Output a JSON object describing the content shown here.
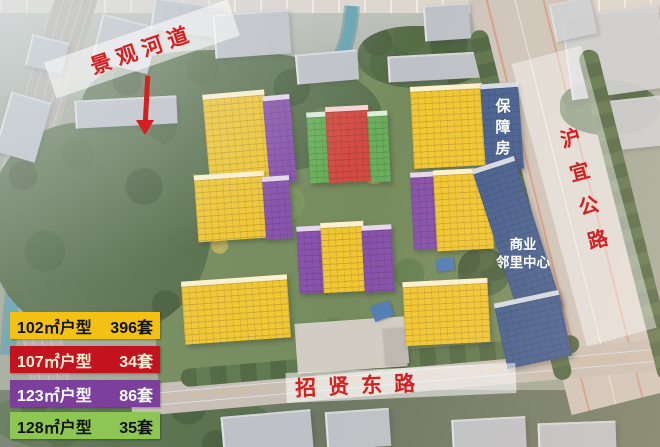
{
  "labels": {
    "river_channel": "景观河道",
    "huyi_highway": "沪宜公路",
    "zhaoxian_east_road": "招贤东路",
    "affordable_housing": "保障房",
    "commercial_center_line1": "商业",
    "commercial_center_line2": "邻里中心"
  },
  "legend": {
    "items": [
      {
        "type": "102㎡户型",
        "count": "396套",
        "bg": "#f2c113",
        "fg": "#111111"
      },
      {
        "type": "107㎡户型",
        "count": "34套",
        "bg": "#c3131f",
        "fg": "#fdf4d6"
      },
      {
        "type": "123㎡户型",
        "count": "86套",
        "bg": "#7c409c",
        "fg": "#ffffff"
      },
      {
        "type": "128㎡户型",
        "count": "35套",
        "bg": "#8dc653",
        "fg": "#111111"
      }
    ]
  },
  "palette": {
    "building-yellow": "#efc11d",
    "building-purple": "#7a3fa5",
    "building-red": "#ce372e",
    "building-green": "#58a74a",
    "building-blue": "#2e4d86",
    "court-blue": "#3f6fae",
    "label-red": "#d32020",
    "legend-yellow": "#f2c113",
    "legend-red": "#c3131f",
    "legend-purple": "#7c409c",
    "legend-green": "#8dc653",
    "water": "#4f98aa",
    "road-gray": "#c9c0b6"
  }
}
